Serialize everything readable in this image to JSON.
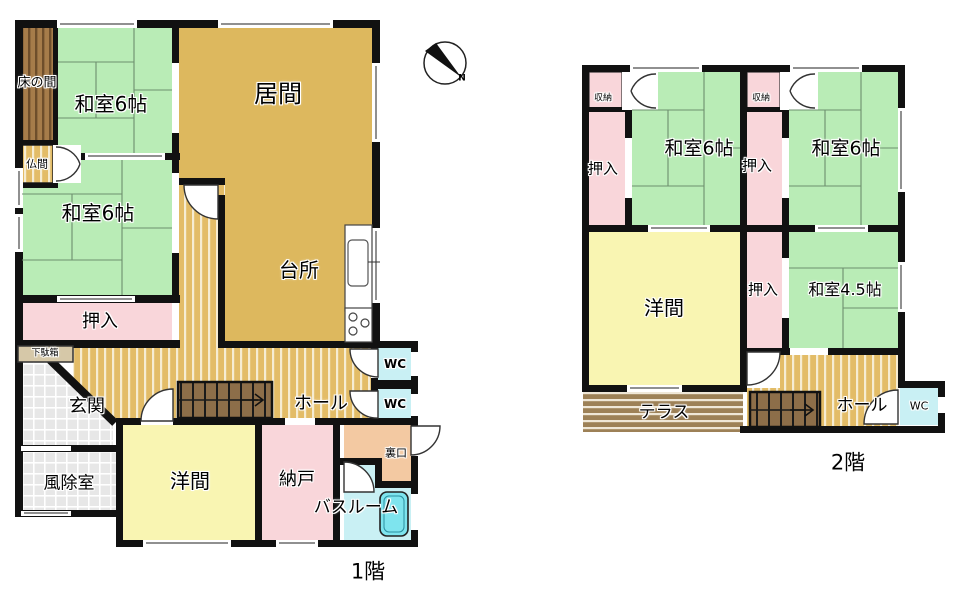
{
  "compass": {
    "north_label": "N"
  },
  "floor1": {
    "caption": "1階",
    "rooms": {
      "tokonoma": "床の間",
      "washitsu_nw": "和室6帖",
      "ima": "居間",
      "butsuma": "仏間",
      "washitsu_w": "和室6帖",
      "daidokoro": "台所",
      "oshiire": "押入",
      "getabako": "下駄箱",
      "genkan": "玄関",
      "fujoshitsu": "風除室",
      "yoma": "洋間",
      "nando": "納戸",
      "bathroom": "バスルーム",
      "uraguchi": "裏口",
      "wc1": "WC",
      "wc2": "WC",
      "hall": "ホール"
    }
  },
  "floor2": {
    "caption": "2階",
    "rooms": {
      "shuno_left": "収納",
      "shuno_right": "収納",
      "washitsu_left": "和室6帖",
      "washitsu_right": "和室6帖",
      "oshiire_left": "押入",
      "oshiire_right_top": "押入",
      "oshiire_right_bottom": "押入",
      "washitsu_45": "和室4.5帖",
      "yoma": "洋間",
      "terrace": "テラス",
      "hall": "ホール",
      "wc": "WC"
    }
  },
  "colors": {
    "wall": "#111111",
    "tatami_green": "#b9ecb6",
    "living_tan": "#ddb85e",
    "hall_tan": "#e3bc67",
    "closet_pink": "#f9d6da",
    "room_yellow": "#f9f5b2",
    "wc_cyan": "#c9f0f4",
    "bathtub_cyan": "#7ee4ee",
    "back_peach": "#f3c9a2",
    "tile_gray": "#e7e7e7",
    "tokonoma_brown": "#a67c4a",
    "terrace_brown": "#9d8157",
    "stairs_brown": "#8d6e49"
  }
}
